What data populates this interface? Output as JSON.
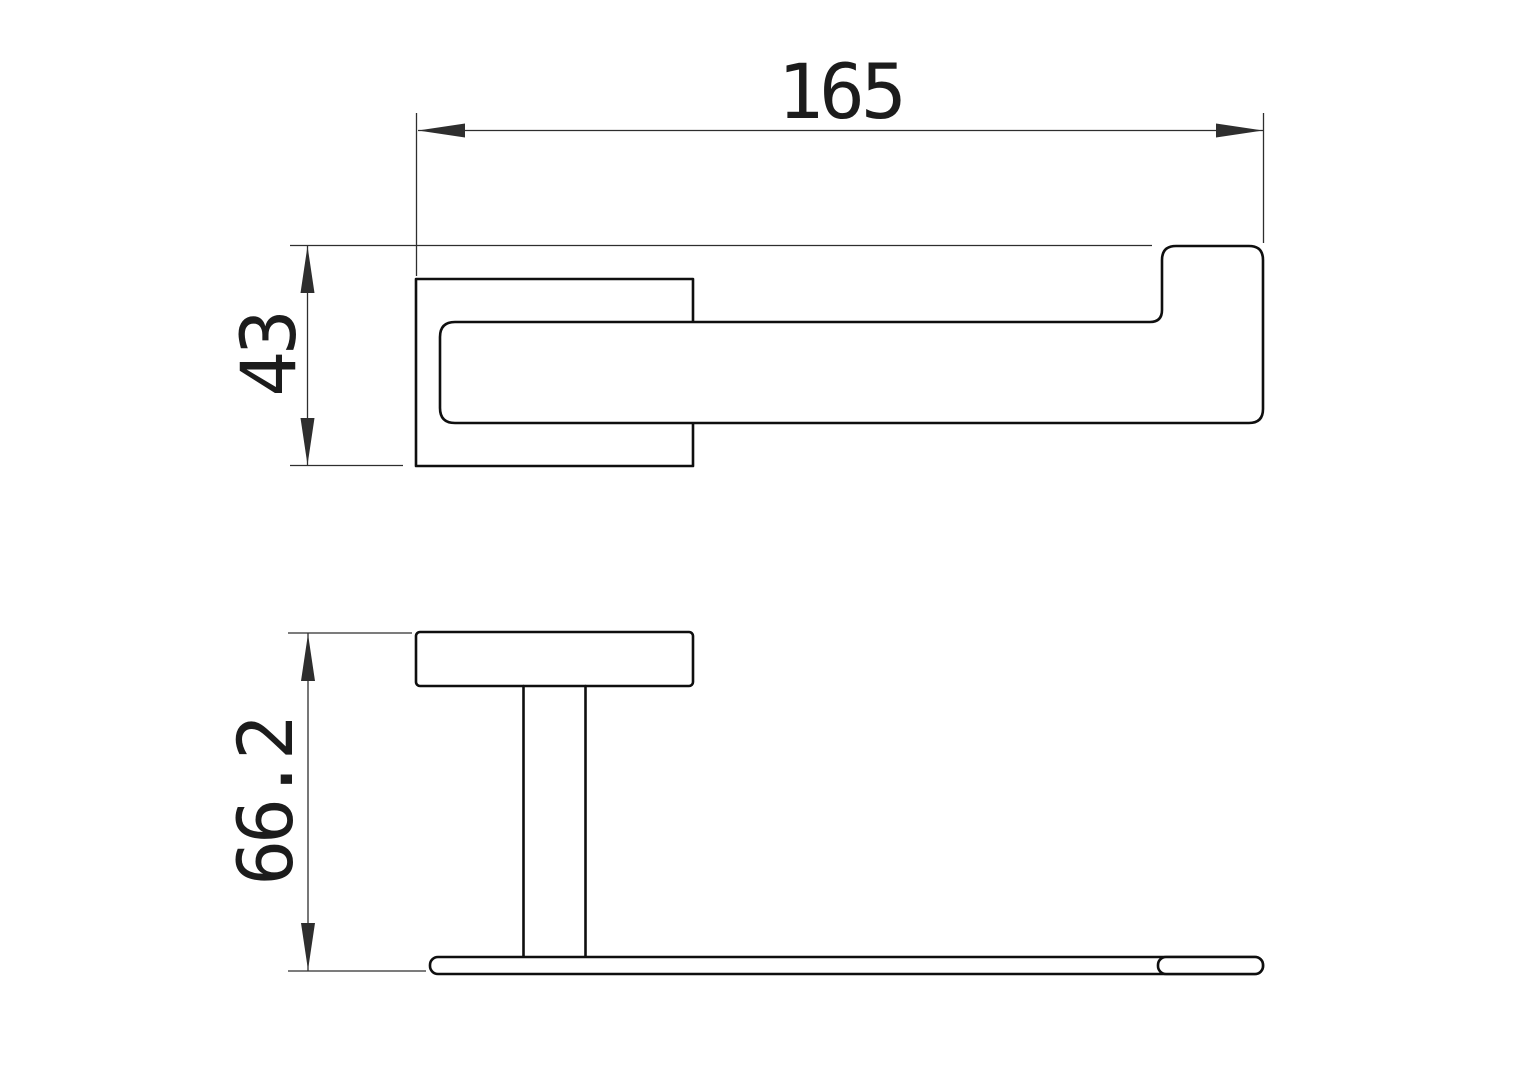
{
  "drawing": {
    "kind": "technical-dimension-drawing",
    "background_color": "#ffffff",
    "outline_color": "#0f0f0f",
    "dimension_color": "#2e2e2e",
    "views": [
      {
        "id": "top-view",
        "dimensions": [
          {
            "id": "overall-width",
            "label": "165",
            "orientation": "horizontal"
          },
          {
            "id": "overall-depth",
            "label": "43",
            "orientation": "vertical"
          }
        ]
      },
      {
        "id": "front-view",
        "dimensions": [
          {
            "id": "overall-height",
            "label": "66.2",
            "orientation": "vertical"
          }
        ]
      }
    ]
  }
}
